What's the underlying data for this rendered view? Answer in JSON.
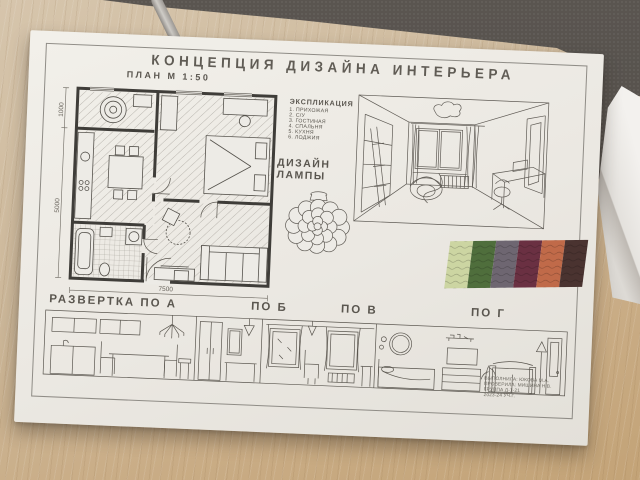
{
  "board": {
    "title": "КОНЦЕПЦИЯ   ДИЗАЙНА   ИНТЕРЬЕРА",
    "plan": {
      "label": "ПЛАН М 1:50",
      "dim_width": "7500",
      "dim_left_top": "1000",
      "dim_left_bottom": "5000"
    },
    "explication": {
      "title": "ЭКСПЛИКАЦИЯ",
      "items": [
        "1. ПРИХОЖАЯ",
        "2. С/У",
        "3. ГОСТИНАЯ",
        "4. СПАЛЬНЯ",
        "5. КУХНЯ",
        "6. ЛОДЖИЯ"
      ]
    },
    "lamp": {
      "line1": "ДИЗАЙН",
      "line2": "ЛАМПЫ"
    },
    "swatches": {
      "colors": [
        "#ccd5a2",
        "#4f6e3c",
        "#6e6671",
        "#6a3042",
        "#c06a49",
        "#4a3330"
      ]
    },
    "elevations": {
      "label_a": "РАЗВЕРТКА ПО А",
      "label_b": "ПО Б",
      "label_v": "ПО В",
      "label_g": "ПО Г"
    },
    "titleblock": {
      "lines": [
        "ВЫПОЛНИЛА: ЮКОВА М.А.",
        "ПРОВЕРИЛА: МИШИНА Н.В.",
        "ГРУППА Д-1-21",
        "2023-24 УЧ.Г."
      ]
    }
  }
}
